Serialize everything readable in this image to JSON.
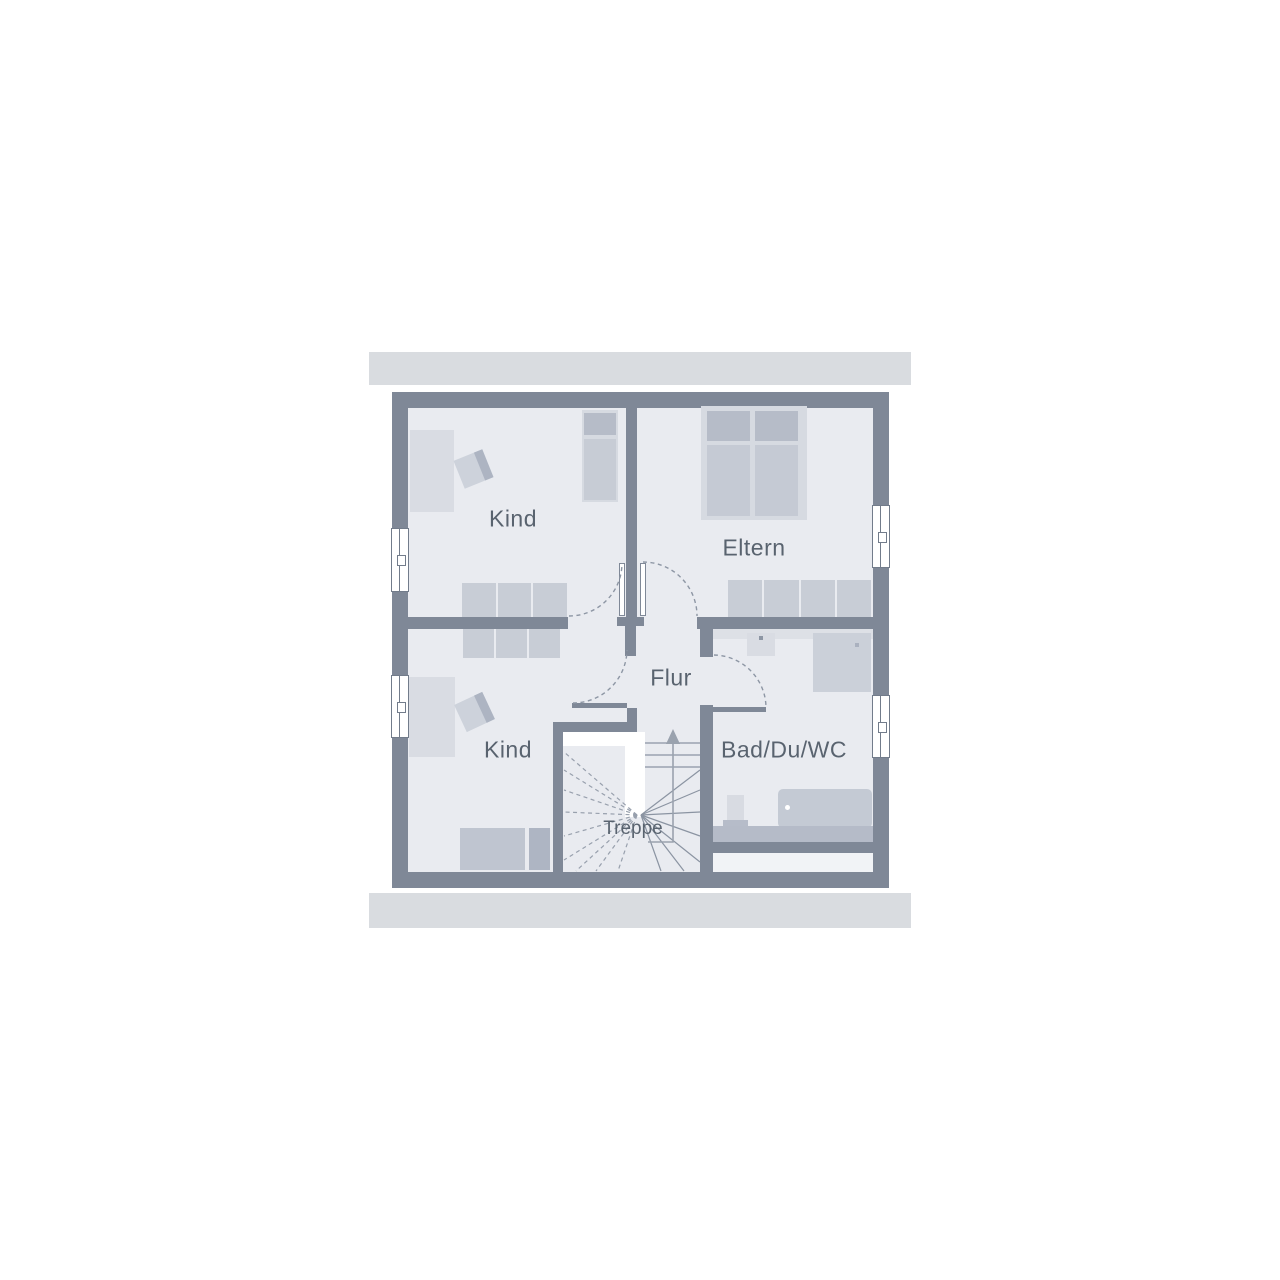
{
  "plan": {
    "rooms": {
      "kind_top": {
        "label": "Kind"
      },
      "eltern": {
        "label": "Eltern"
      },
      "kind_bottom": {
        "label": "Kind"
      },
      "flur": {
        "label": "Flur"
      },
      "bath": {
        "label": "Bad/Du/WC"
      },
      "stairs": {
        "label": "Treppe"
      }
    },
    "colors": {
      "background": "#ffffff",
      "wall": "#7f8897",
      "floor": "#e9ebf0",
      "eave_band": "#d9dce0",
      "furniture_light": "#d9dce3",
      "furniture_medium": "#c7ccd6",
      "furniture_dark": "#b5bbc8",
      "door_swing_dash": "#8d96a4",
      "stair_tread_line": "#8b94a2",
      "label_text": "#59636f"
    },
    "symbols": [
      "window-symbol",
      "door-swing-arc",
      "door-leaf",
      "single-bed",
      "double-bed",
      "wardrobe",
      "desk",
      "desk-chair",
      "washbasin",
      "shower",
      "bathtub",
      "toilet",
      "staircase",
      "stair-direction-arrow"
    ]
  }
}
